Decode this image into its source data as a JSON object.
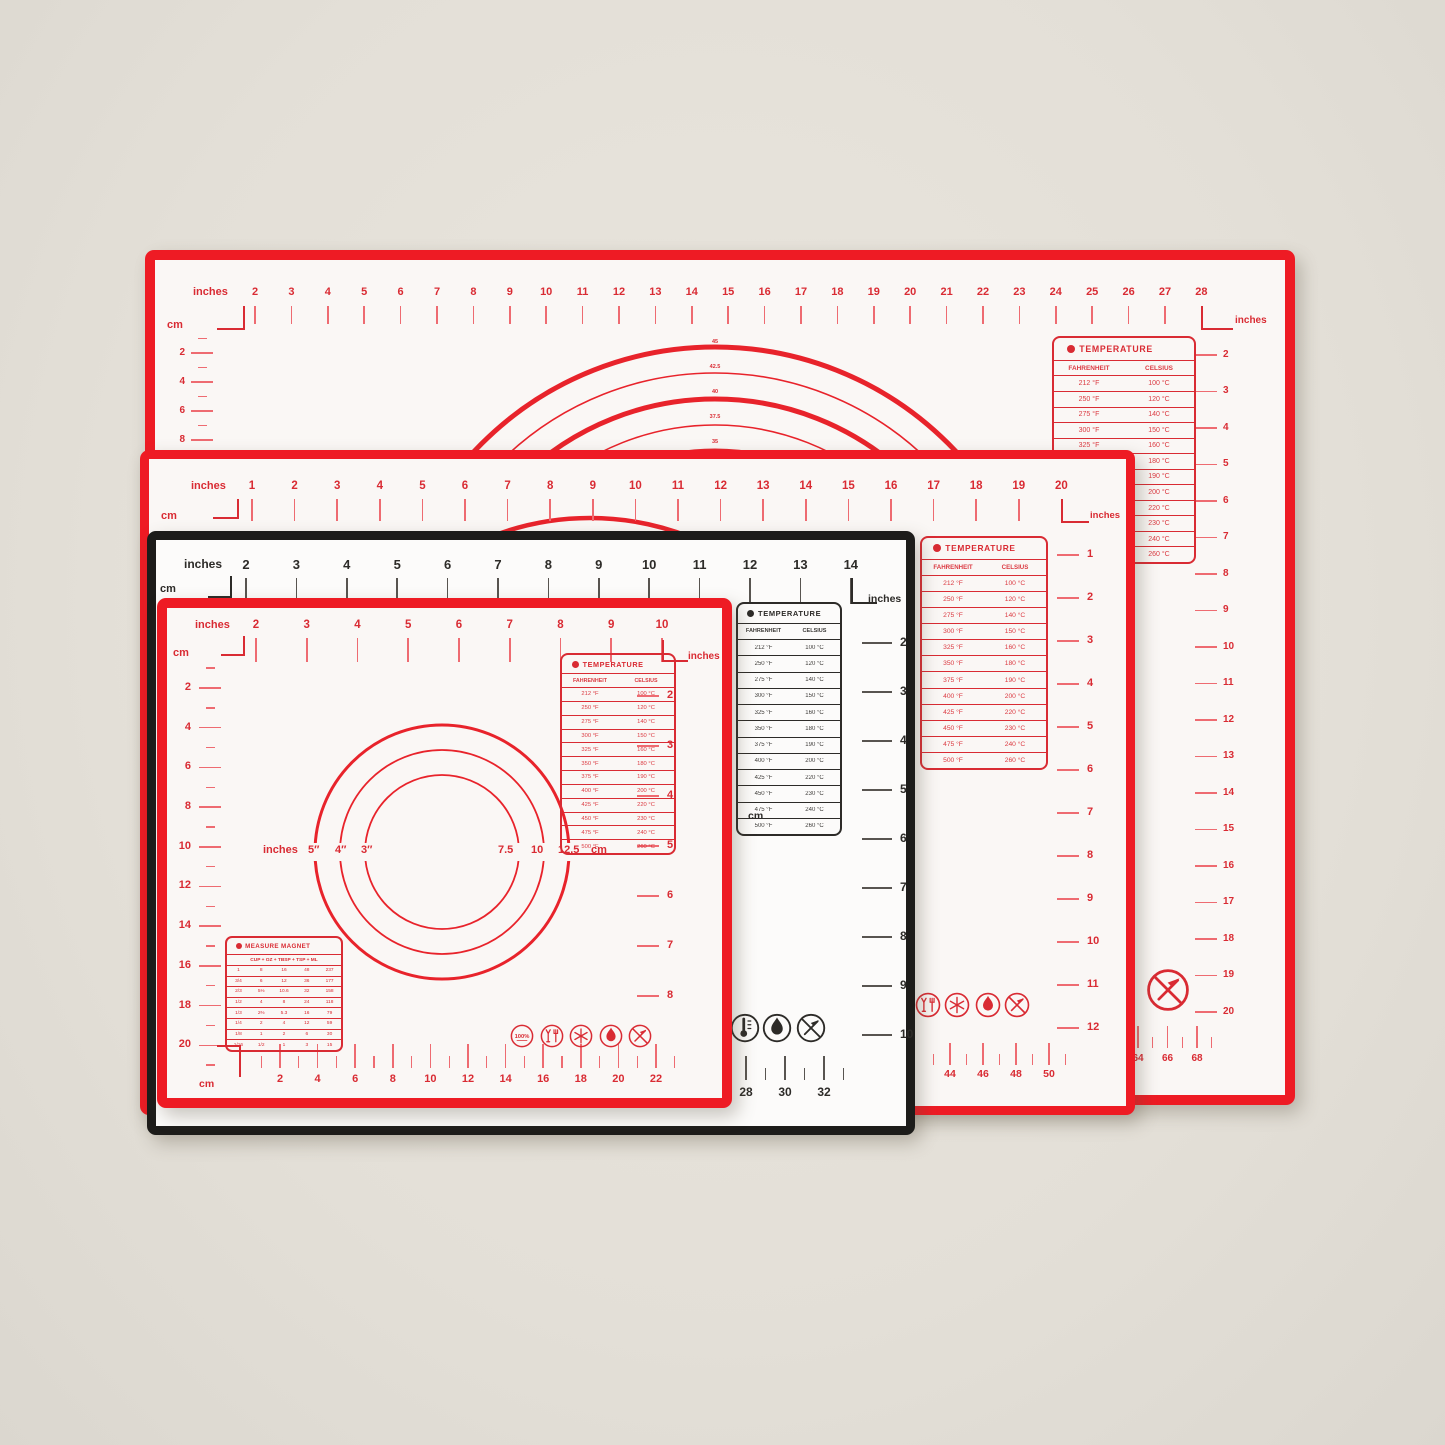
{
  "labels": {
    "inches": "inches",
    "cm": "cm"
  },
  "temperature": {
    "title": "TEMPERATURE",
    "columns": [
      "FAHRENHEIT",
      "CELSIUS"
    ],
    "rows": [
      [
        "212 °F",
        "100 °C"
      ],
      [
        "250 °F",
        "120 °C"
      ],
      [
        "275 °F",
        "140 °C"
      ],
      [
        "300 °F",
        "150 °C"
      ],
      [
        "325 °F",
        "160 °C"
      ],
      [
        "350 °F",
        "180 °C"
      ],
      [
        "375 °F",
        "190 °C"
      ],
      [
        "400 °F",
        "200 °C"
      ],
      [
        "425 °F",
        "220 °C"
      ],
      [
        "450 °F",
        "230 °C"
      ],
      [
        "475 °F",
        "240 °C"
      ],
      [
        "500 °F",
        "260 °C"
      ]
    ]
  },
  "measure_magnet": {
    "title": "MEASURE MAGNET",
    "header": "CUP + OZ + TBSP + TSP + ML",
    "rows": [
      [
        "1",
        "8",
        "16",
        "48",
        "237"
      ],
      [
        "3/4",
        "6",
        "12",
        "36",
        "177"
      ],
      [
        "2/3",
        "5⅓",
        "10.6",
        "32",
        "158"
      ],
      [
        "1/2",
        "4",
        "8",
        "24",
        "118"
      ],
      [
        "1/3",
        "2⅔",
        "5.3",
        "16",
        "79"
      ],
      [
        "1/4",
        "2",
        "4",
        "12",
        "59"
      ],
      [
        "1/8",
        "1",
        "2",
        "6",
        "30"
      ],
      [
        "1/16",
        "1/2",
        "1",
        "3",
        "15"
      ]
    ]
  },
  "icons": {
    "badge_text": "100%"
  },
  "mats": {
    "xl": {
      "top_numbers": [
        2,
        3,
        4,
        5,
        6,
        7,
        8,
        9,
        10,
        11,
        12,
        13,
        14,
        15,
        16,
        17,
        18,
        19,
        20,
        21,
        22,
        23,
        24,
        25,
        26,
        27,
        28
      ],
      "left_numbers": [
        2,
        4,
        6,
        8
      ],
      "right_numbers": [
        2,
        3,
        4,
        5,
        6,
        7,
        8,
        9,
        10,
        11,
        12,
        13,
        14,
        15,
        16,
        17,
        18,
        19,
        20
      ],
      "bottom_numbers": [
        64,
        66,
        68
      ],
      "arc_labels": [
        "45",
        "42.5",
        "40",
        "37.5",
        "35"
      ],
      "icons": [
        "no-knife"
      ]
    },
    "l": {
      "top_numbers": [
        1,
        2,
        3,
        4,
        5,
        6,
        7,
        8,
        9,
        10,
        11,
        12,
        13,
        14,
        15,
        16,
        17,
        18,
        19,
        20
      ],
      "right_numbers": [
        1,
        2,
        3,
        4,
        5,
        6,
        7,
        8,
        9,
        10,
        11,
        12
      ],
      "bottom_numbers": [
        44,
        46,
        48,
        50
      ],
      "icons": [
        "food-safe",
        "snowflake",
        "flame",
        "no-knife"
      ]
    },
    "m": {
      "top_numbers": [
        2,
        3,
        4,
        5,
        6,
        7,
        8,
        9,
        10,
        11,
        12,
        13,
        14
      ],
      "right_numbers": [
        2,
        3,
        4,
        5,
        6,
        7,
        8,
        9,
        10
      ],
      "bottom_numbers": [
        28,
        30,
        32
      ],
      "fragment": [
        "0",
        "cm"
      ],
      "icons": [
        "thermometer",
        "flame",
        "no-knife"
      ]
    },
    "s": {
      "top_numbers": [
        2,
        3,
        4,
        5,
        6,
        7,
        8,
        9,
        10
      ],
      "left_numbers": [
        2,
        4,
        6,
        8,
        10,
        12,
        14,
        16,
        18,
        20
      ],
      "right_numbers": [
        2,
        3,
        4,
        5,
        6,
        7,
        8
      ],
      "bottom_numbers": [
        2,
        4,
        6,
        8,
        10,
        12,
        14,
        16,
        18,
        20,
        22
      ],
      "circle_left_labels": [
        "inches",
        "5″",
        "4″",
        "3″"
      ],
      "circle_right_labels": [
        "7.5",
        "10",
        "12.5",
        "cm"
      ],
      "icons": [
        "badge-100",
        "food-safe",
        "snowflake",
        "flame",
        "no-knife"
      ]
    }
  }
}
